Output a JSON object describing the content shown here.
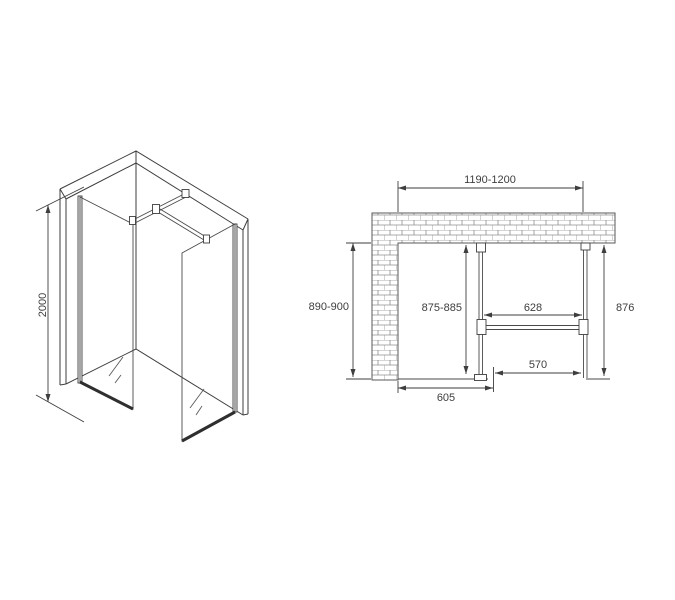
{
  "drawing": {
    "iso": {
      "height": "2000"
    },
    "plan": {
      "width": "1190-1200",
      "side_wall_depth": "890-900",
      "panel1_depth": "875-885",
      "bar_length": "628",
      "panel2_depth": "876",
      "entry_width": "570",
      "panel1_offset": "605"
    },
    "colors": {
      "line": "#3e3e3e",
      "brick_line": "#8f8f8f",
      "glass_bottom_edge": "#2f2f2f",
      "background": "#ffffff"
    }
  }
}
